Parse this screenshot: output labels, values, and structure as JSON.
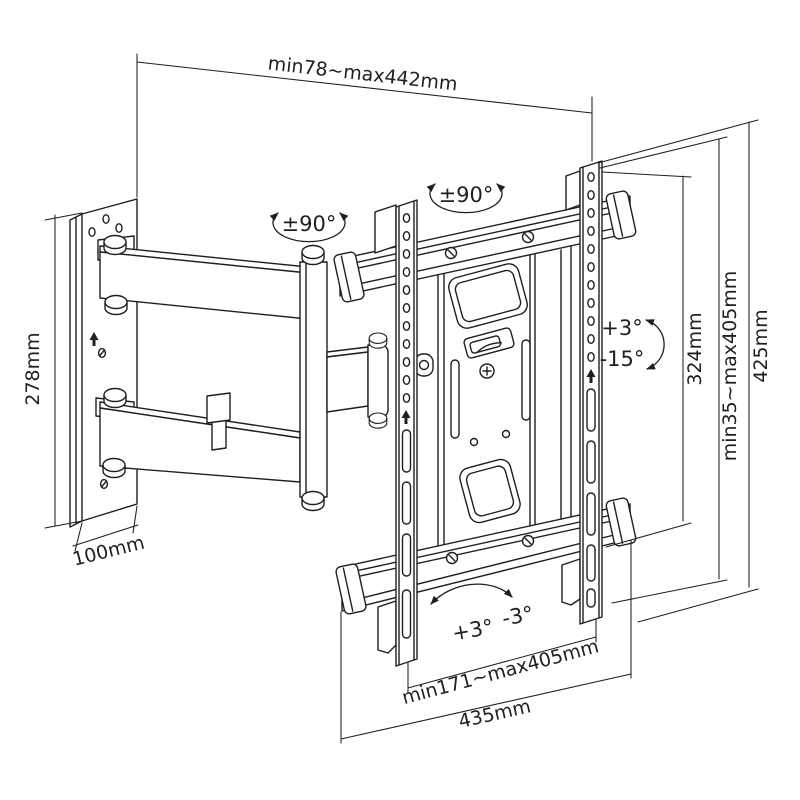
{
  "colors": {
    "line": "#1f1f1f",
    "bg": "#ffffff"
  },
  "diagram": {
    "dimensions": {
      "extension_depth": "min78~max442mm",
      "wall_plate_height": "278mm",
      "wall_plate_width": "100mm",
      "vesa_inner_height": "324mm",
      "tv_height_range": "min35~max405mm",
      "bracket_height": "425mm",
      "rail_span_range": "min171~max405mm",
      "bracket_width": "435mm"
    },
    "angles": {
      "swivel_arm": "±90°",
      "swivel_mount": "±90°",
      "tilt_up": "+3°",
      "tilt_down": "-15°",
      "level_plus": "+3°",
      "level_minus": "-3°"
    }
  }
}
